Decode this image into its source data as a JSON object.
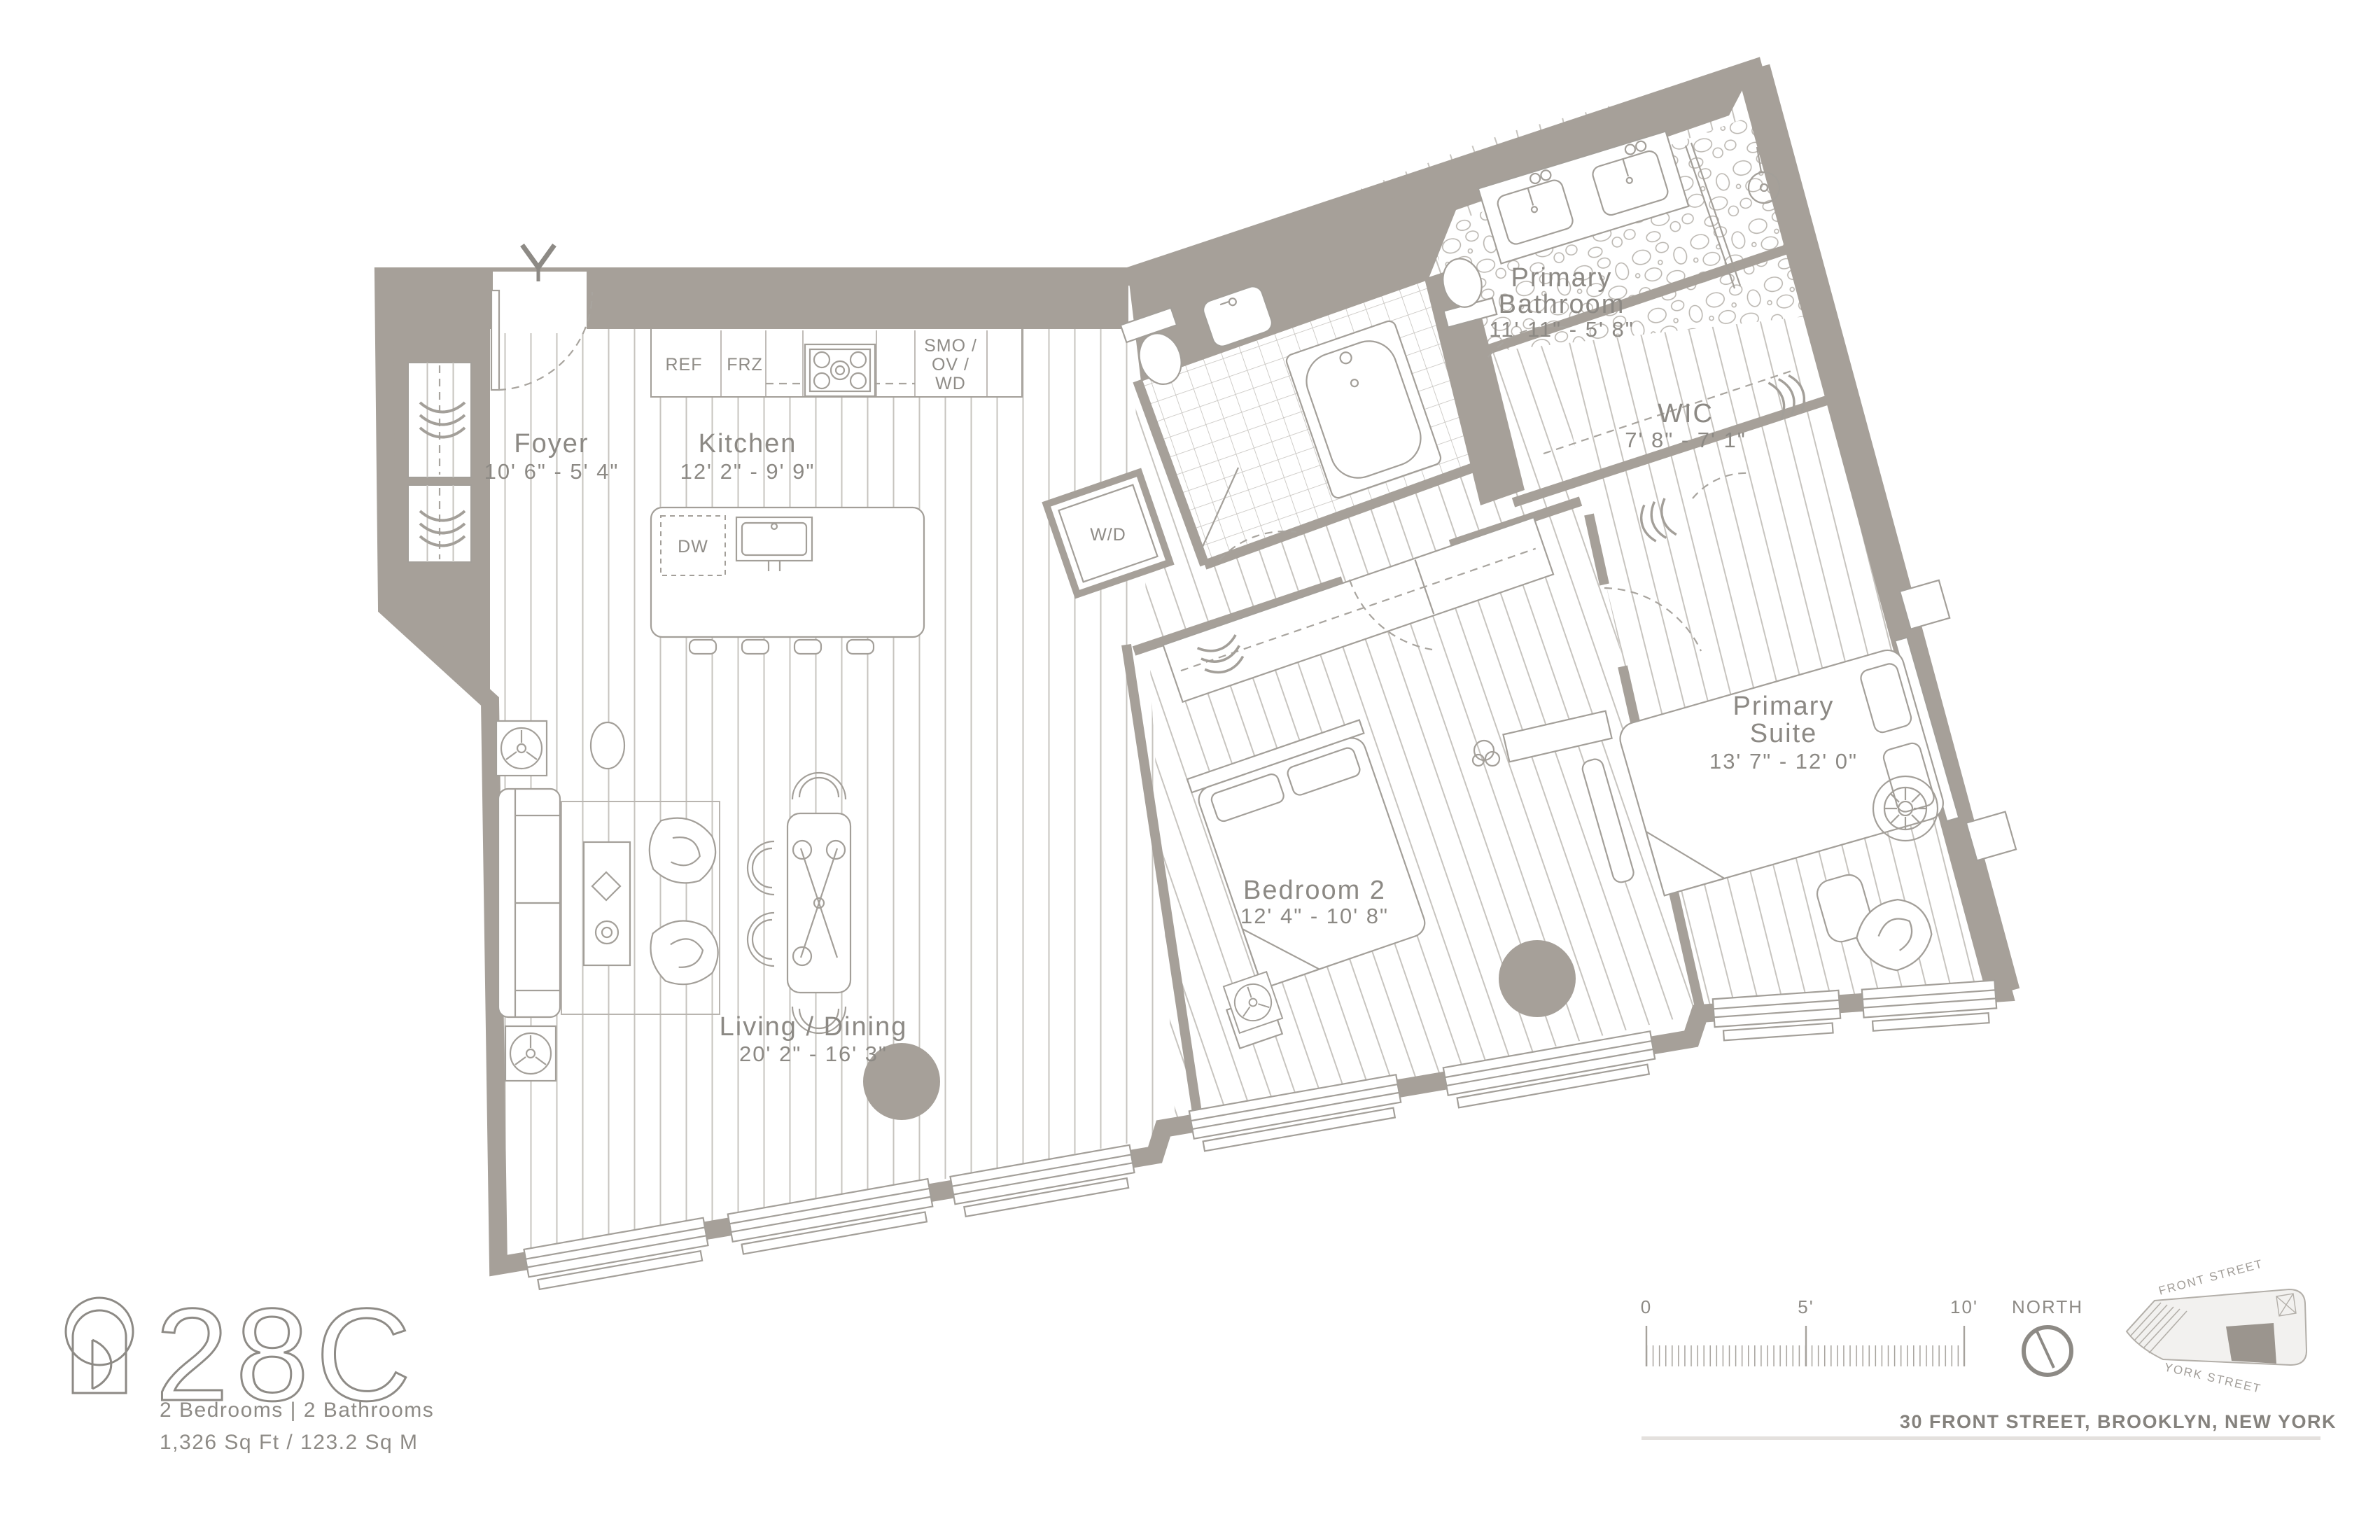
{
  "unit": {
    "number": "28C",
    "specs": "2 Bedrooms  |  2 Bathrooms",
    "area": "1,326 Sq Ft / 123.2 Sq M"
  },
  "address": "30 FRONT STREET, BROOKLYN, NEW YORK",
  "rooms": {
    "foyer": {
      "name": "Foyer",
      "dims": "10' 6\" - 5' 4\""
    },
    "kitchen": {
      "name": "Kitchen",
      "dims": "12' 2\" - 9' 9\""
    },
    "living_dining": {
      "name": "Living / Dining",
      "dims": "20' 2\" - 16' 3\""
    },
    "bedroom_2": {
      "name": "Bedroom 2",
      "dims": "12' 4\" - 10' 8\""
    },
    "primary_suite": {
      "line1": "Primary",
      "line2": "Suite",
      "dims": "13' 7\" - 12' 0\""
    },
    "primary_bathroom": {
      "line1": "Primary",
      "line2": "Bathroom",
      "dims": "11' 11\" - 5' 8\""
    },
    "wic": {
      "name": "WIC",
      "dims": "7' 8\" - 7' 1\""
    }
  },
  "appliances": {
    "ref": "REF",
    "frz": "FRZ",
    "smo": "SMO /",
    "ov": "OV /",
    "wd": "WD",
    "dw": "DW",
    "washer_dryer": "W/D"
  },
  "scale_bar": {
    "zero": "0",
    "five": "5'",
    "ten": "10'"
  },
  "compass": {
    "label": "NORTH"
  },
  "keyplan": {
    "street_top": "FRONT STREET",
    "street_bottom": "YORK STREET"
  },
  "colors": {
    "wall": "#a6a099",
    "line": "#a39f99",
    "text": "#8c8984"
  }
}
